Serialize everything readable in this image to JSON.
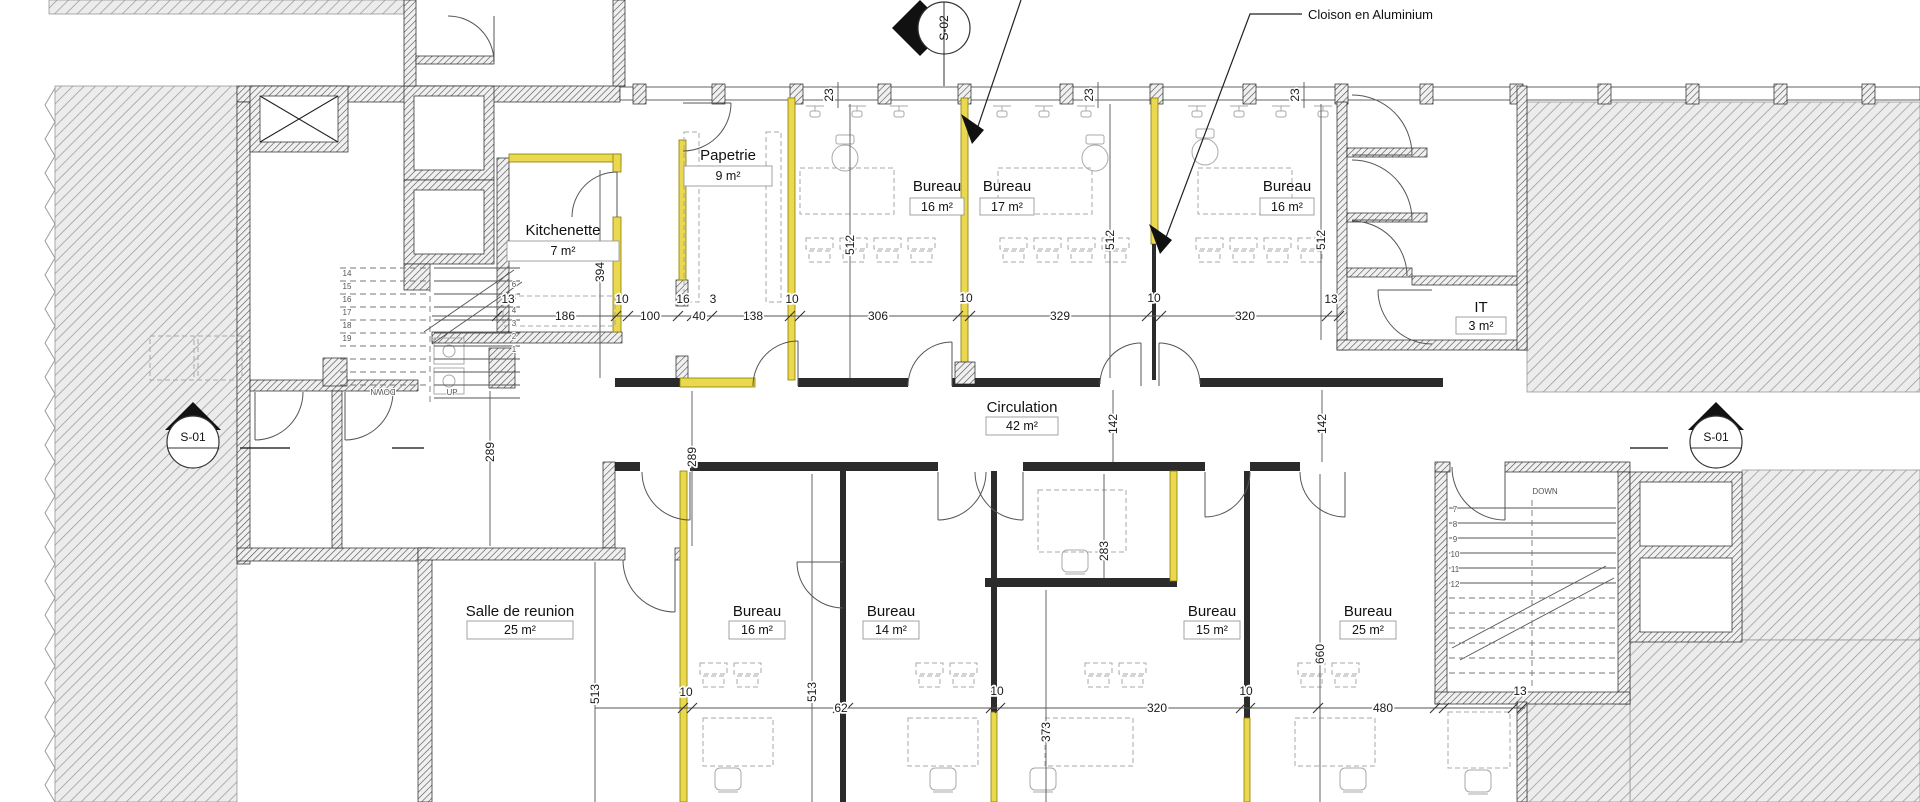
{
  "note": {
    "cloison": "Cloison en Aluminium"
  },
  "markers": {
    "s02": "S-02",
    "s01_left": "S-01",
    "s01_right": "S-01"
  },
  "rooms": {
    "papetrie": {
      "name": "Papetrie",
      "area": "9 m²"
    },
    "kitchenette": {
      "name": "Kitchenette",
      "area": "7 m²"
    },
    "bureau_top_left": {
      "name": "Bureau",
      "area": "16 m²"
    },
    "bureau_top_mid": {
      "name": "Bureau",
      "area": "17 m²"
    },
    "bureau_top_right": {
      "name": "Bureau",
      "area": "16 m²"
    },
    "it": {
      "name": "IT",
      "area": "3 m²"
    },
    "circulation": {
      "name": "Circulation",
      "area": "42 m²"
    },
    "salle_reunion": {
      "name": "Salle de reunion",
      "area": "25 m²"
    },
    "bureau_bottom_1": {
      "name": "Bureau",
      "area": "16 m²"
    },
    "bureau_bottom_2": {
      "name": "Bureau",
      "area": "14 m²"
    },
    "bureau_bottom_3": {
      "name": "Bureau",
      "area": "15 m²"
    },
    "bureau_bottom_4": {
      "name": "Bureau",
      "area": "25 m²"
    }
  },
  "stairs": {
    "left": {
      "down": "DOWN",
      "up": "UP",
      "down_numbers": [
        "14",
        "15",
        "16",
        "17",
        "18",
        "19"
      ],
      "up_numbers": [
        "6",
        "5",
        "4",
        "3",
        "2",
        "1"
      ]
    },
    "right": {
      "down": "DOWN",
      "numbers": [
        "7",
        "8",
        "9",
        "10",
        "11",
        "12"
      ]
    }
  },
  "dims": {
    "t23a": "23",
    "t23b": "23",
    "t23c": "23",
    "m13a": "13",
    "m186": "186",
    "m10a": "10",
    "m100": "100",
    "m16": "16",
    "m40": "40",
    "m3": "3",
    "m138": "138",
    "m10b": "10",
    "m306": "306",
    "m10c": "10",
    "m329": "329",
    "m10d": "10",
    "m320": "320",
    "m13b": "13",
    "v394": "394",
    "v512a": "512",
    "v512b": "512",
    "v512c": "512",
    "v289a": "289",
    "v289b": "289",
    "v142a": "142",
    "v142b": "142",
    "v283": "283",
    "v660": "660",
    "v513a": "513",
    "v513b": "513",
    "v373": "373",
    "b10a": "10",
    "b62": "62",
    "b10b": "10",
    "b320": "320",
    "b10c": "10",
    "b480": "480",
    "b13": "13"
  },
  "colors": {
    "new_partition": "#ead94e",
    "wall_hatch": "#454545",
    "exterior_hatch": "#9b9b9b",
    "furniture": "#a8a8a8"
  }
}
